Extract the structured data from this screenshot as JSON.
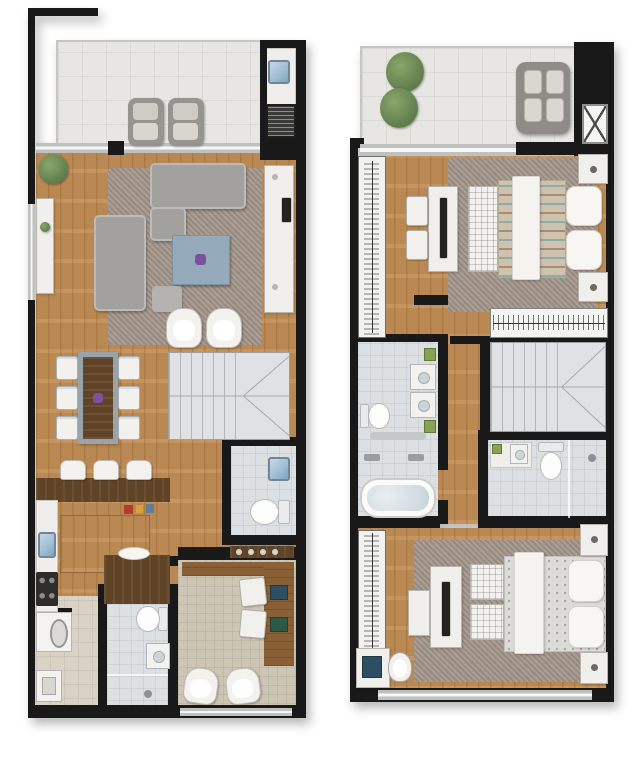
{
  "image": {
    "type": "two-storey apartment floor plan render",
    "width": 640,
    "height": 768,
    "background": "#ffffff"
  },
  "palette": {
    "bg": "#ffffff",
    "wall": "#191919",
    "wood": "#c28e55",
    "wood_mid": "#8a6136",
    "wood_dark": "#5e4326",
    "terrace": "#e7e6e3",
    "rug": "#a2958a",
    "stairs": "#e0e1e2",
    "bath": "#dce0e2",
    "beige": "#cdc6b4",
    "laundry": "#d9d3c6",
    "sofa": "#a3a19e",
    "white_furniture": "#f0efec",
    "table_blue": "#94aabb",
    "accent_purple": "#7b50a0",
    "sink_blue": "#9dbdd3",
    "plant": "#5f7d4c",
    "window": "#bfc1c0"
  },
  "plans": [
    {
      "name": "lower-floor",
      "position": "left",
      "rooms": [
        {
          "name": "terrace",
          "furniture": [
            "lounge-chair",
            "lounge-chair",
            "gourmet-sink",
            "barbecue-grill"
          ]
        },
        {
          "name": "living-room",
          "furniture": [
            "sofa",
            "chaise",
            "loveseat",
            "blue-coffee-table",
            "pouf",
            "armchair",
            "armchair",
            "sideboard",
            "tv",
            "console",
            "plant",
            "rug"
          ]
        },
        {
          "name": "dining-room",
          "furniture": [
            "dining-table",
            "chair",
            "chair",
            "chair",
            "chair",
            "chair",
            "chair",
            "purple-centerpiece"
          ]
        },
        {
          "name": "staircase",
          "furniture": []
        },
        {
          "name": "kitchen",
          "furniture": [
            "bar-counter",
            "stool",
            "stool",
            "stool",
            "sink",
            "cooktop",
            "island",
            "peninsula"
          ]
        },
        {
          "name": "powder-room",
          "furniture": [
            "toilet",
            "washbasin",
            "shelf"
          ]
        },
        {
          "name": "laundry",
          "furniture": [
            "washing-machine",
            "laundry-sink"
          ]
        },
        {
          "name": "bathroom",
          "furniture": [
            "toilet",
            "washbasin",
            "shower"
          ]
        },
        {
          "name": "home-office",
          "furniture": [
            "l-desk",
            "office-chair",
            "office-chair",
            "laptop",
            "laptop",
            "armchair",
            "armchair"
          ]
        }
      ]
    },
    {
      "name": "upper-floor",
      "position": "right",
      "rooms": [
        {
          "name": "balcony",
          "furniture": [
            "plant",
            "plant",
            "lounge-chair"
          ]
        },
        {
          "name": "elevator",
          "furniture": []
        },
        {
          "name": "bedroom-suite",
          "furniture": [
            "double-bed",
            "foot-bench",
            "nightstand",
            "nightstand",
            "dresser-tv",
            "chair",
            "chair",
            "wardrobe",
            "rug"
          ]
        },
        {
          "name": "clothes-rack",
          "furniture": [
            "clothes-rail"
          ]
        },
        {
          "name": "master-bathroom",
          "furniture": [
            "bathtub",
            "toilet",
            "washbasin",
            "washbasin",
            "plant",
            "plant",
            "towel-rail"
          ]
        },
        {
          "name": "staircase",
          "furniture": []
        },
        {
          "name": "bathroom-2",
          "furniture": [
            "toilet",
            "washbasin",
            "shower"
          ]
        },
        {
          "name": "bedroom-2",
          "furniture": [
            "double-bed",
            "ottoman",
            "ottoman",
            "nightstand",
            "nightstand",
            "dresser-tv",
            "wardrobe",
            "desk",
            "laptop",
            "office-chair",
            "armchair",
            "rug"
          ]
        }
      ]
    }
  ]
}
